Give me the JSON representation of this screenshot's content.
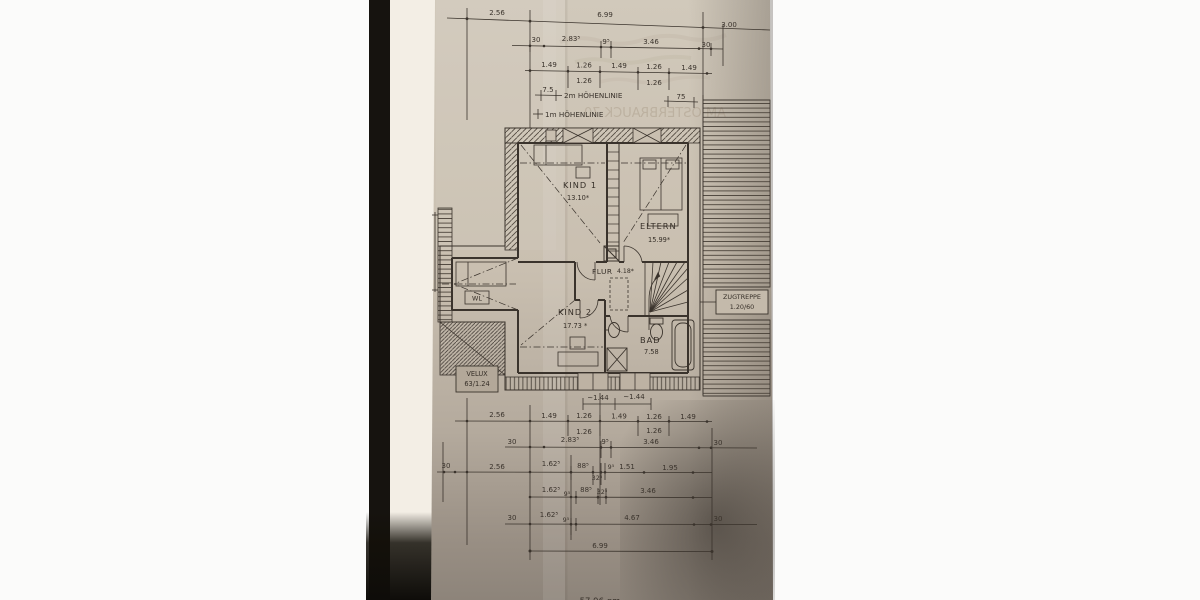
{
  "document_type": "floor-plan-blueprint-photo",
  "rooms": {
    "kind1": {
      "name": "KIND 1",
      "area": "13.10*"
    },
    "eltern": {
      "name": "ELTERN",
      "area": "15.99*"
    },
    "flur": {
      "name": "FLUR",
      "area": "4.18*"
    },
    "kind2": {
      "name": "KIND 2",
      "area": "17.73 *"
    },
    "bad": {
      "name": "BAD",
      "area": "7.58"
    }
  },
  "labels": {
    "hoehenlinie_2m": "2m HÖHENLINIE",
    "hoehenlinie_1m": "1m HÖHENLINIE",
    "zugtreppe": [
      "ZUGTREPPE",
      "1.20/60"
    ],
    "velux": [
      "VELUX",
      "63/1.24"
    ],
    "wl": "WL",
    "total_area": "57.96 qm",
    "ghost_text": "AM OSTERBRAUCK 70"
  },
  "dimensions": {
    "top_row1": [
      "2.56",
      "6.99",
      "3.00"
    ],
    "top_row2": [
      "30",
      "2.83⁵",
      "9⁵",
      "3.46",
      "30"
    ],
    "top_row3": [
      "1.49",
      "1.26",
      "1.49",
      "1.26",
      "1.49"
    ],
    "top_row3_sub": [
      "1.26",
      "1.26"
    ],
    "top_row4": [
      "7.5",
      "75"
    ],
    "plan_bottom": [
      "~1.44",
      "~1.44"
    ],
    "bot_row1": [
      "2.56",
      "1.49",
      "1.26",
      "1.49",
      "1.26",
      "1.49"
    ],
    "bot_row1_sub": [
      "1.26",
      "1.26"
    ],
    "bot_row2": [
      "30",
      "2.83⁵",
      "9⁵",
      "3.46",
      "30"
    ],
    "bot_row3": [
      "30",
      "2.56",
      "1.62⁵",
      "88⁵",
      "32⁵",
      "9⁵",
      "1.51",
      "1.95"
    ],
    "bot_row4": [
      "1.62⁵",
      "9⁵",
      "88⁵",
      "32⁵",
      "3.46"
    ],
    "bot_row5": [
      "30",
      "1.62⁵",
      "9⁵",
      "4.67",
      "30"
    ],
    "bot_row6": [
      "6.99"
    ]
  },
  "colors": {
    "paper": "#cbc2b3",
    "ink": "#3a332c",
    "background": "#fbfbfa",
    "shadow_band": "#16130f"
  }
}
